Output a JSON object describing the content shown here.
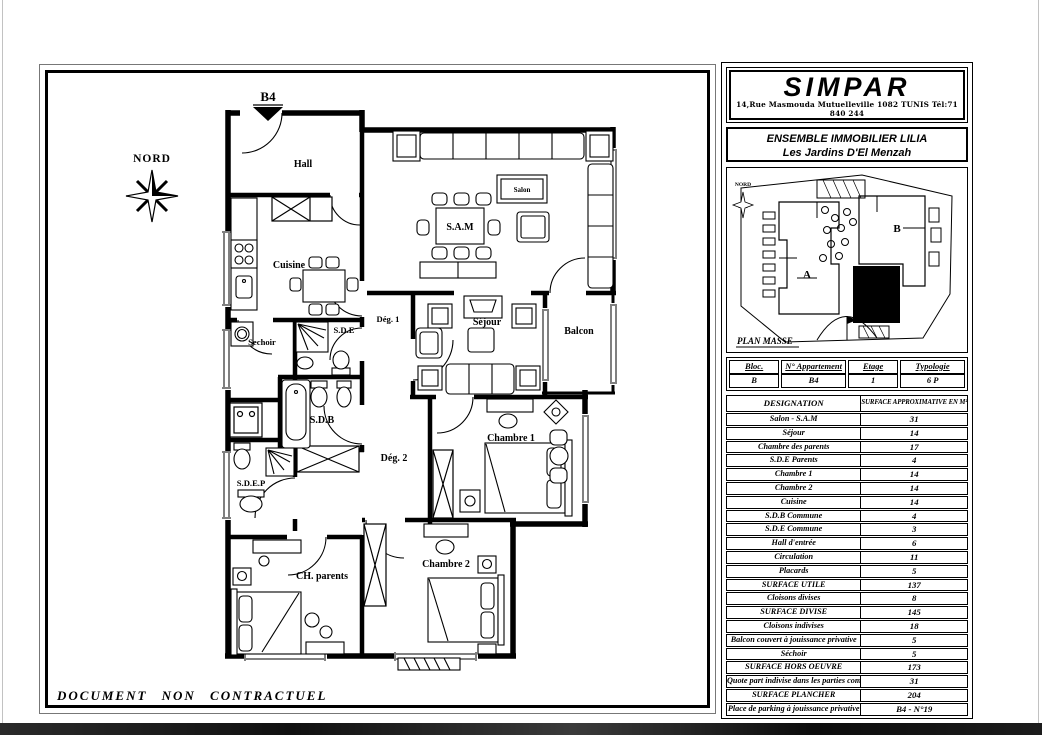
{
  "page": {
    "footer_note": "DOCUMENT NON CONTRACTUEL"
  },
  "brand": {
    "name": "SIMPAR",
    "address": "14,Rue Masmouda Mutuelleville 1082 TUNIS Tél:71 840 244"
  },
  "project": {
    "line1": "ENSEMBLE IMMOBILIER LILIA",
    "line2": "Les Jardins D'El Menzah"
  },
  "site_plan": {
    "title": "PLAN MASSE",
    "north": "NORD",
    "building_a": "A",
    "building_b": "B"
  },
  "floorplan": {
    "unit": "B4",
    "north": "NORD",
    "rooms": {
      "hall": "Hall",
      "cuisine": "Cuisine",
      "salon": "Salon",
      "sam": "S.A.M",
      "sejour": "Séjour",
      "balcon": "Balcon",
      "deg1": "Dég. 1",
      "deg2": "Dég. 2",
      "sechoir": "Sechoir",
      "sde": "S.D.E",
      "sdb": "S.D.B",
      "sdep": "S.D.E.P",
      "chambre1": "Chambre 1",
      "chambre2": "Chambre 2",
      "ch_parents": "CH. parents"
    }
  },
  "unit_info": {
    "headers": [
      "Bloc.",
      "N° Appartement",
      "Etage",
      "Typologie"
    ],
    "values": [
      "B",
      "B4",
      "1",
      "6 P"
    ]
  },
  "surface_table": {
    "col_label": "DESIGNATION",
    "col_value": "SURFACE APPROXIMATIVE EN M²",
    "rows": [
      {
        "label": "Salon - S.A.M",
        "value": "31"
      },
      {
        "label": "Séjour",
        "value": "14"
      },
      {
        "label": "Chambre des parents",
        "value": "17"
      },
      {
        "label": "S.D.E Parents",
        "value": "4"
      },
      {
        "label": "Chambre 1",
        "value": "14"
      },
      {
        "label": "Chambre 2",
        "value": "14"
      },
      {
        "label": "Cuisine",
        "value": "14"
      },
      {
        "label": "S.D.B Commune",
        "value": "4"
      },
      {
        "label": "S.D.E Commune",
        "value": "3"
      },
      {
        "label": "Hall d'entrée",
        "value": "6"
      },
      {
        "label": "Circulation",
        "value": "11"
      },
      {
        "label": "Placards",
        "value": "5"
      },
      {
        "label": "SURFACE UTILE",
        "value": "137"
      },
      {
        "label": "Cloisons divises",
        "value": "8"
      },
      {
        "label": "SURFACE DIVISE",
        "value": "145"
      },
      {
        "label": "Cloisons indivises",
        "value": "18"
      },
      {
        "label": "Balcon couvert à jouissance privative",
        "value": "5"
      },
      {
        "label": "Séchoir",
        "value": "5"
      },
      {
        "label": "SURFACE HORS OEUVRE",
        "value": "173"
      },
      {
        "label": "Quote part indivise dans les parties communes",
        "value": "31"
      },
      {
        "label": "SURFACE PLANCHER",
        "value": "204"
      },
      {
        "label": "Place de parking à jouissance privative",
        "value": "B4 - N°19"
      }
    ]
  }
}
